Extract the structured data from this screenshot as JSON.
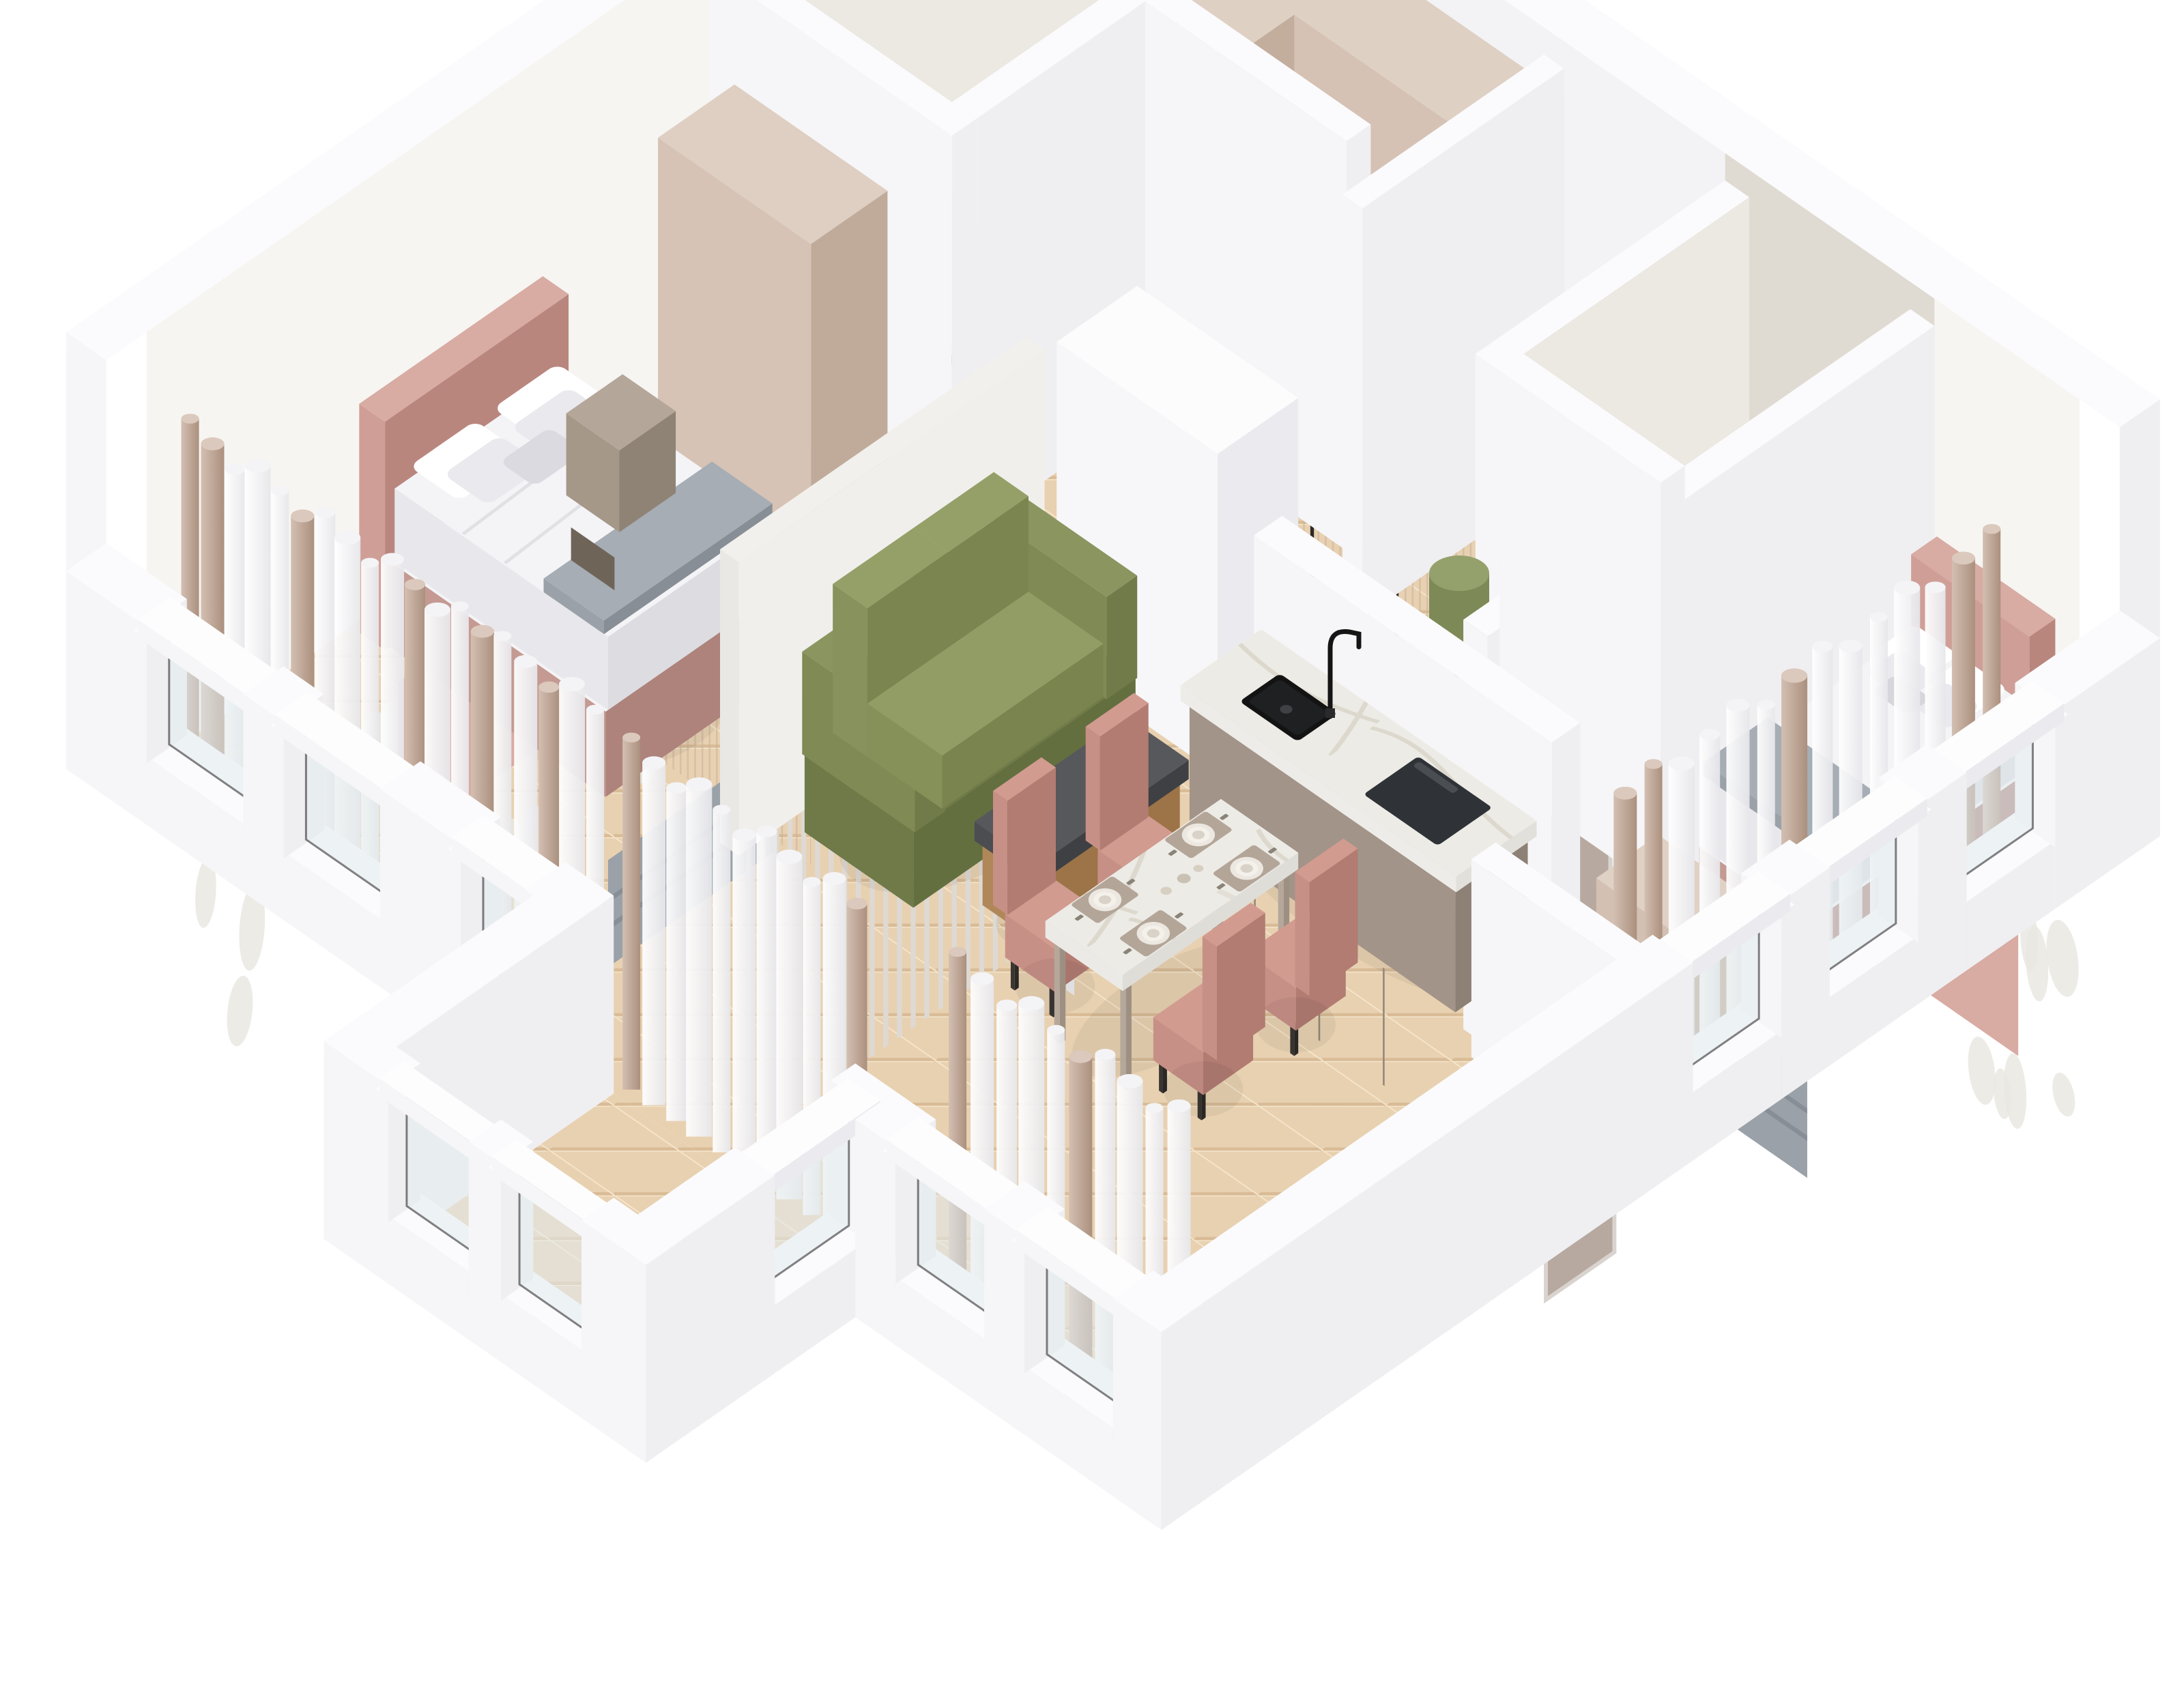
{
  "meta": {
    "description": "Isometric 3D cutaway render of an apartment floor plan with two pink bedrooms, marble bathrooms, entry wardrobe closet, green sofa living area, kitchen island and dining set",
    "projection": "isometric-dollhouse",
    "visible_text": ""
  },
  "palette": {
    "bg": "#ffffff",
    "wallTop": "#fbfbfd",
    "wallLight": "#f6f6f8",
    "wallMid": "#efeff2",
    "wallDark": "#e7e7eb",
    "wallInner": "#f3f3f6",
    "floorWood": "#e8d1b1",
    "woodGrain": "#d9bc97",
    "woodSeam": "#f6e8ce",
    "marbleFloor": "#edebe6",
    "marbleVein": "#d9d3c7",
    "marbleWall": "#ece8e2",
    "marbleWallDark": "#e0dbd2",
    "wallpaper": "#f6f5f2",
    "wallpaperMotif": "#e9e7e2",
    "wardrobe": "#d5c2b4",
    "wardrobeTop": "#dfd0c4",
    "wardrobeSide": "#c3ae9e",
    "ribLine": "#c7b09d",
    "handleDark": "#2c2926",
    "doorTaupe": "#b7a99f",
    "doorTaupeDark": "#9d8f85",
    "doorFrame": "#d9d3cf",
    "doorWhite": "#f6f6f8",
    "bedPink": "#cf9f97",
    "bedPinkLight": "#d8aba3",
    "bedPinkDark": "#b9867e",
    "bedding": "#f4f4f7",
    "beddingShade": "#dcdce1",
    "pillowShade": "#e9e9ee",
    "throwGray": "#9aa1a8",
    "throwDark": "#878e96",
    "throwTop": "#a6adb4",
    "sofaGreen": "#87925c",
    "sofaGreenLight": "#95a068",
    "sofaGreenDark": "#6f7a48",
    "poufGreen": "#7d8a57",
    "poufGreenTop": "#95a16c",
    "tableTan": "#b08758",
    "tableTanLight": "#bb9166",
    "slabDark": "#4b4d50",
    "slabDarkTop": "#56585b",
    "islandBase": "#a29488",
    "islandBaseDark": "#8d8075",
    "counter": "#f4f2ef",
    "counterSide": "#e2e0db",
    "sinkBlack": "#131313",
    "cooktop": "#2f3236",
    "chrome": "#a6abb0",
    "black": "#151515",
    "chairPink": "#c79086",
    "chairPinkLight": "#d29b90",
    "chairPinkDark": "#b27c72",
    "mat": "#b3a698",
    "plate": "#ece7e0",
    "plateInner": "#f4f0ea",
    "bowl": "#d9d2c8",
    "cutlery": "#8a8377",
    "glassFill": "#e3ecef",
    "frameDark": "#1d1d1f",
    "mirrorFrame": "#161616",
    "curtainTaupe1": "#d3bfb2",
    "curtainTaupe2": "#ab907e",
    "curtainWhite1": "#ffffff",
    "curtainWhite2": "#e7e7eb",
    "shadow": "#000000"
  },
  "scene": {
    "rooms": [
      {
        "id": "bedroom-left",
        "furniture": [
          "double-bed-pink",
          "wardrobe-beige",
          "nightstand",
          "sheer-curtains"
        ]
      },
      {
        "id": "bathroom-left",
        "furniture": [
          "round-mirror",
          "vanity-white",
          "marble-walls"
        ]
      },
      {
        "id": "entry-closet",
        "furniture": [
          "ribbed-wardrobe-run",
          "ribbed-wardrobe-side"
        ]
      },
      {
        "id": "entry-hall",
        "furniture": [
          "entrance-door",
          "oval-mirror",
          "green-pouf",
          "door-mat"
        ]
      },
      {
        "id": "bathroom-right",
        "furniture": [
          "bathtub",
          "shower-set",
          "marble-walls",
          "door-taupe"
        ]
      },
      {
        "id": "bedroom-right",
        "furniture": [
          "double-bed-pink",
          "dresser-beige",
          "sheer-curtains",
          "door-taupe"
        ]
      },
      {
        "id": "kitchen",
        "furniture": [
          "island-marble-top",
          "black-sink",
          "black-faucet",
          "induction-cooktop",
          "half-wall"
        ]
      },
      {
        "id": "living-room",
        "furniture": [
          "green-sofa",
          "coffee-table-concrete-top",
          "slat-partition",
          "media-volume-white"
        ]
      },
      {
        "id": "dining-area",
        "furniture": [
          "marble-dining-table",
          "pink-chair",
          "pink-chair",
          "pink-chair",
          "pink-chair",
          "place-settings"
        ]
      },
      {
        "id": "balcony-corridor",
        "furniture": [
          "glass-balustrade-windows",
          "sheer-curtains"
        ]
      }
    ]
  }
}
